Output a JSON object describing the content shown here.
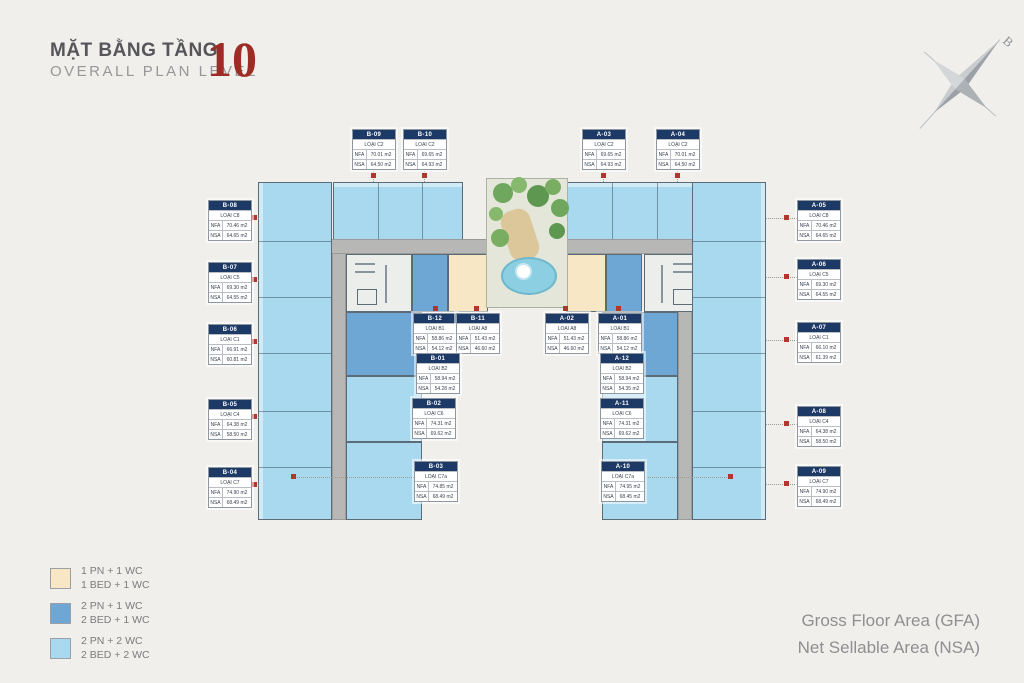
{
  "header": {
    "title_vi": "MẶT BẰNG TẦNG",
    "title_en": "OVERALL PLAN LEVEL",
    "level_number": "10"
  },
  "compass": {
    "label": "B"
  },
  "labels": {
    "nfa": "NFA",
    "nsa": "NSA"
  },
  "units": [
    {
      "id": "B-09",
      "type": "LOẠI C2",
      "nfa": "70.01 m2",
      "nsa": "64.50 m2"
    },
    {
      "id": "B-10",
      "type": "LOẠI C2",
      "nfa": "69.65 m2",
      "nsa": "64.93 m2"
    },
    {
      "id": "A-03",
      "type": "LOẠI C2",
      "nfa": "69.65 m2",
      "nsa": "64.93 m2"
    },
    {
      "id": "A-04",
      "type": "LOẠI C2",
      "nfa": "70.01 m2",
      "nsa": "64.50 m2"
    },
    {
      "id": "B-08",
      "type": "LOẠI C8",
      "nfa": "70.46 m2",
      "nsa": "64.65 m2"
    },
    {
      "id": "B-07",
      "type": "LOẠI C5",
      "nfa": "69.30 m2",
      "nsa": "64.55 m2"
    },
    {
      "id": "B-06",
      "type": "LOẠI C1",
      "nfa": "66.91 m2",
      "nsa": "60.81 m2"
    },
    {
      "id": "B-05",
      "type": "LOẠI C4",
      "nfa": "64.38 m2",
      "nsa": "58.50 m2"
    },
    {
      "id": "B-04",
      "type": "LOẠI C7",
      "nfa": "74.90 m2",
      "nsa": "68.49 m2"
    },
    {
      "id": "A-05",
      "type": "LOẠI C8",
      "nfa": "70.46 m2",
      "nsa": "64.65 m2"
    },
    {
      "id": "A-06",
      "type": "LOẠI C5",
      "nfa": "69.30 m2",
      "nsa": "64.55 m2"
    },
    {
      "id": "A-07",
      "type": "LOẠI C1",
      "nfa": "66.10 m2",
      "nsa": "61.39 m2"
    },
    {
      "id": "A-08",
      "type": "LOẠI C4",
      "nfa": "64.38 m2",
      "nsa": "58.50 m2"
    },
    {
      "id": "A-09",
      "type": "LOẠI C7",
      "nfa": "74.90 m2",
      "nsa": "68.49 m2"
    },
    {
      "id": "B-12",
      "type": "LOẠI B1",
      "nfa": "58.86 m2",
      "nsa": "54.12 m2"
    },
    {
      "id": "B-11",
      "type": "LOẠI A8",
      "nfa": "51.43 m2",
      "nsa": "46.60 m2"
    },
    {
      "id": "A-02",
      "type": "LOẠI A8",
      "nfa": "51.43 m2",
      "nsa": "46.60 m2"
    },
    {
      "id": "A-01",
      "type": "LOẠI B1",
      "nfa": "58.86 m2",
      "nsa": "54.12 m2"
    },
    {
      "id": "B-01",
      "type": "LOẠI B2",
      "nfa": "58.94 m2",
      "nsa": "54.28 m2"
    },
    {
      "id": "A-12",
      "type": "LOẠI B2",
      "nfa": "58.94 m2",
      "nsa": "54.35 m2"
    },
    {
      "id": "B-02",
      "type": "LOẠI C6",
      "nfa": "74.31 m2",
      "nsa": "69.62 m2"
    },
    {
      "id": "A-11",
      "type": "LOẠI C6",
      "nfa": "74.31 m2",
      "nsa": "69.62 m2"
    },
    {
      "id": "B-03",
      "type": "LOẠI C7a",
      "nfa": "74.85 m2",
      "nsa": "68.49 m2"
    },
    {
      "id": "A-10",
      "type": "LOẠI C7a",
      "nfa": "74.95 m2",
      "nsa": "68.45 m2"
    }
  ],
  "legend": {
    "items": [
      {
        "color": "#f8e7c4",
        "line1": "1 PN + 1 WC",
        "line2": "1 BED + 1 WC"
      },
      {
        "color": "#6ea7d4",
        "line1": "2 PN + 1 WC",
        "line2": "2 BED + 1 WC"
      },
      {
        "color": "#a9d9ef",
        "line1": "2 PN + 2 WC",
        "line2": "2 BED + 2 WC"
      }
    ]
  },
  "footer": {
    "line1": "Gross Floor Area (GFA)",
    "line2": "Net Sellable Area (NSA)"
  },
  "colors": {
    "background": "#f0efec",
    "unit_1bed": "#f8e7c4",
    "unit_2bed_1wc": "#6ea7d4",
    "unit_2bed_2wc": "#a9d9ef",
    "corridor": "#b7b7b5",
    "box_header_navy": "#1d3a66",
    "level_red": "#9d2c26",
    "marker_red": "#b0372e"
  }
}
